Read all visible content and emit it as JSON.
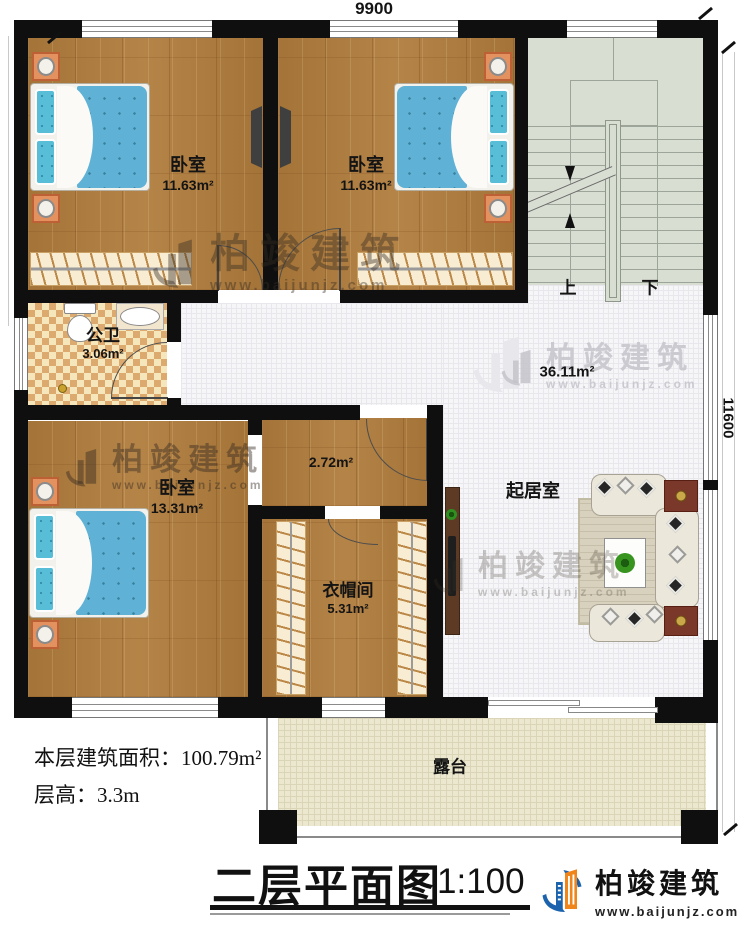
{
  "dimensions": {
    "width_mm": "9900",
    "height_mm": "11600"
  },
  "rooms": {
    "bedroom1": {
      "name": "卧室",
      "area": "11.63m²"
    },
    "bedroom2": {
      "name": "卧室",
      "area": "11.63m²"
    },
    "bathroom": {
      "name": "公卫",
      "area": "3.06m²"
    },
    "corridor": {
      "area": "2.72m²"
    },
    "bedroom3": {
      "name": "卧室",
      "area": "13.31m²"
    },
    "cloakroom": {
      "name": "衣帽间",
      "area": "5.31m²"
    },
    "living": {
      "name": "起居室",
      "area": "36.11m²"
    },
    "terrace": {
      "name": "露台"
    },
    "stairs": {
      "up": "上",
      "down": "下"
    }
  },
  "notes": {
    "area_label": "本层建筑面积：",
    "area_value": "100.79m²",
    "height_label": "层高：",
    "height_value": "3.3m"
  },
  "titleblock": {
    "title": "二层平面图",
    "scale": "1:100"
  },
  "brand": {
    "name": "柏竣建筑",
    "url": "www.baijunjz.com"
  },
  "colors": {
    "wall": "#0f0f0f",
    "wood": "#b07c3c",
    "tile": "#f6f6f8",
    "stair": "#d9ded3",
    "checker_dark": "#dcaa6e",
    "checker_light": "#f6e6bb",
    "terrace": "#ece8cf",
    "bed_fabric": "#5fb2d6",
    "brand_blue": "#1c63ae",
    "brand_orange": "#f08519"
  }
}
